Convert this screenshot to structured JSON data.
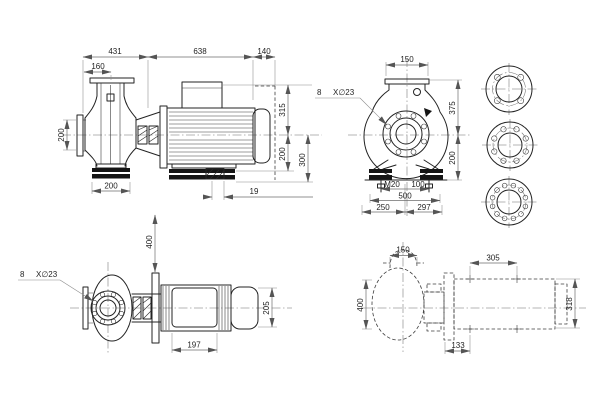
{
  "drawing": {
    "side_view": {
      "top_dims": [
        "431",
        "638",
        "140"
      ],
      "flange_width": "160",
      "left_dim": "200",
      "right_dims": [
        "315",
        "200",
        "300"
      ],
      "bottom_dims": [
        "200",
        "19"
      ]
    },
    "front_view": {
      "top_dim": "150",
      "bolt_note": {
        "count": "8",
        "spec": "X∅23"
      },
      "right_dims": [
        "375",
        "200"
      ],
      "bottom_dims": [
        "M20",
        "100",
        "500",
        "250",
        "297"
      ]
    },
    "plan_view": {
      "bolt_note": {
        "count": "8",
        "spec": "X∅23"
      },
      "vertical_dim": "400",
      "motor_width": "205",
      "foot_span": "197"
    },
    "outline_view": {
      "top_dims": [
        "150",
        "305"
      ],
      "left_dim": "400",
      "right_dim": "318",
      "bottom_dim": "133"
    }
  }
}
